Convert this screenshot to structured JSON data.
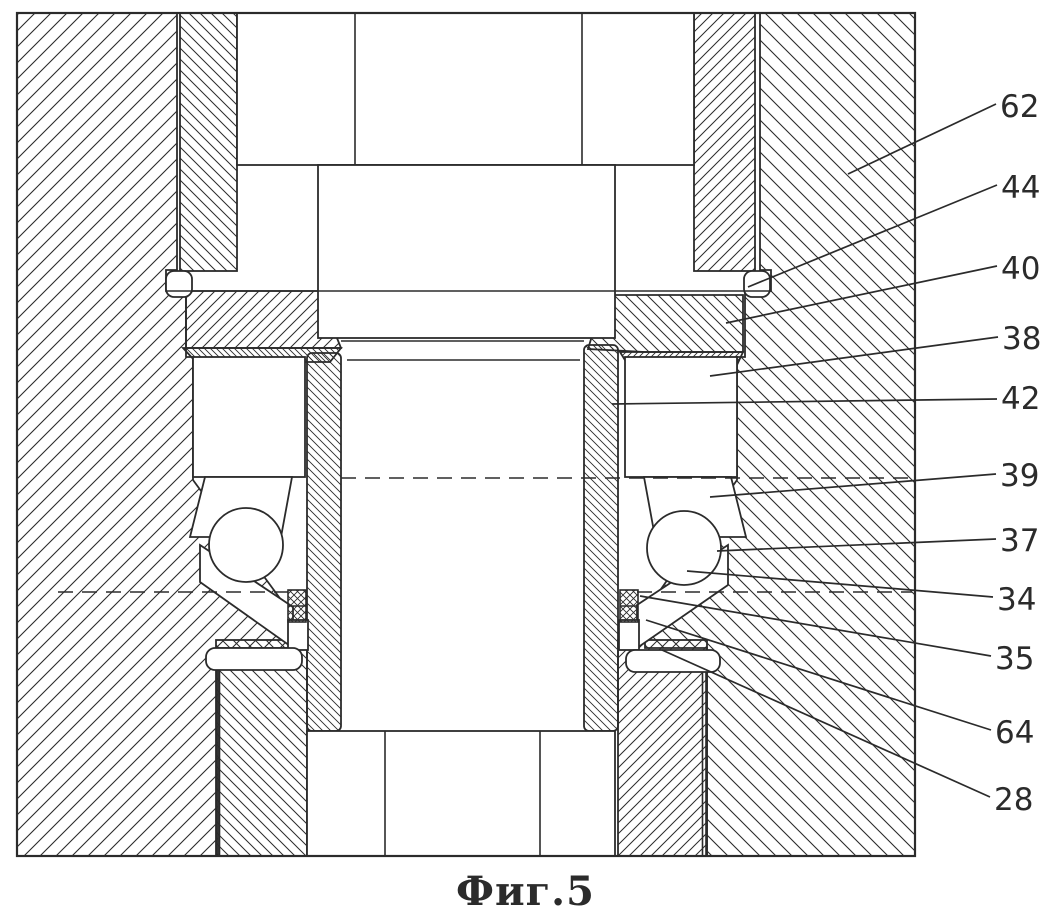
{
  "figure": {
    "caption": "Фиг.5"
  },
  "colors": {
    "ink": "#2b2b2b",
    "paper": "#ffffff"
  },
  "callouts": [
    {
      "text": "62",
      "tx": 1000,
      "ty": 117,
      "x1": 996,
      "y1": 104,
      "x2": 848,
      "y2": 174
    },
    {
      "text": "44",
      "tx": 1001,
      "ty": 198,
      "x1": 997,
      "y1": 185,
      "x2": 748,
      "y2": 287
    },
    {
      "text": "40",
      "tx": 1001,
      "ty": 279,
      "x1": 997,
      "y1": 266,
      "x2": 726,
      "y2": 323
    },
    {
      "text": "38",
      "tx": 1002,
      "ty": 349,
      "x1": 998,
      "y1": 337,
      "x2": 710,
      "y2": 376
    },
    {
      "text": "42",
      "tx": 1001,
      "ty": 409,
      "x1": 997,
      "y1": 399,
      "x2": 612,
      "y2": 404
    },
    {
      "text": "39",
      "tx": 1000,
      "ty": 486,
      "x1": 996,
      "y1": 474,
      "x2": 710,
      "y2": 497
    },
    {
      "text": "37",
      "tx": 1000,
      "ty": 551,
      "x1": 996,
      "y1": 539,
      "x2": 717,
      "y2": 551
    },
    {
      "text": "34",
      "tx": 997,
      "ty": 610,
      "x1": 993,
      "y1": 597,
      "x2": 687,
      "y2": 571
    },
    {
      "text": "35",
      "tx": 995,
      "ty": 669,
      "x1": 991,
      "y1": 656,
      "x2": 640,
      "y2": 596
    },
    {
      "text": "64",
      "tx": 995,
      "ty": 743,
      "x1": 991,
      "y1": 730,
      "x2": 646,
      "y2": 620
    },
    {
      "text": "28",
      "tx": 994,
      "ty": 810,
      "x1": 990,
      "y1": 797,
      "x2": 662,
      "y2": 650
    }
  ]
}
